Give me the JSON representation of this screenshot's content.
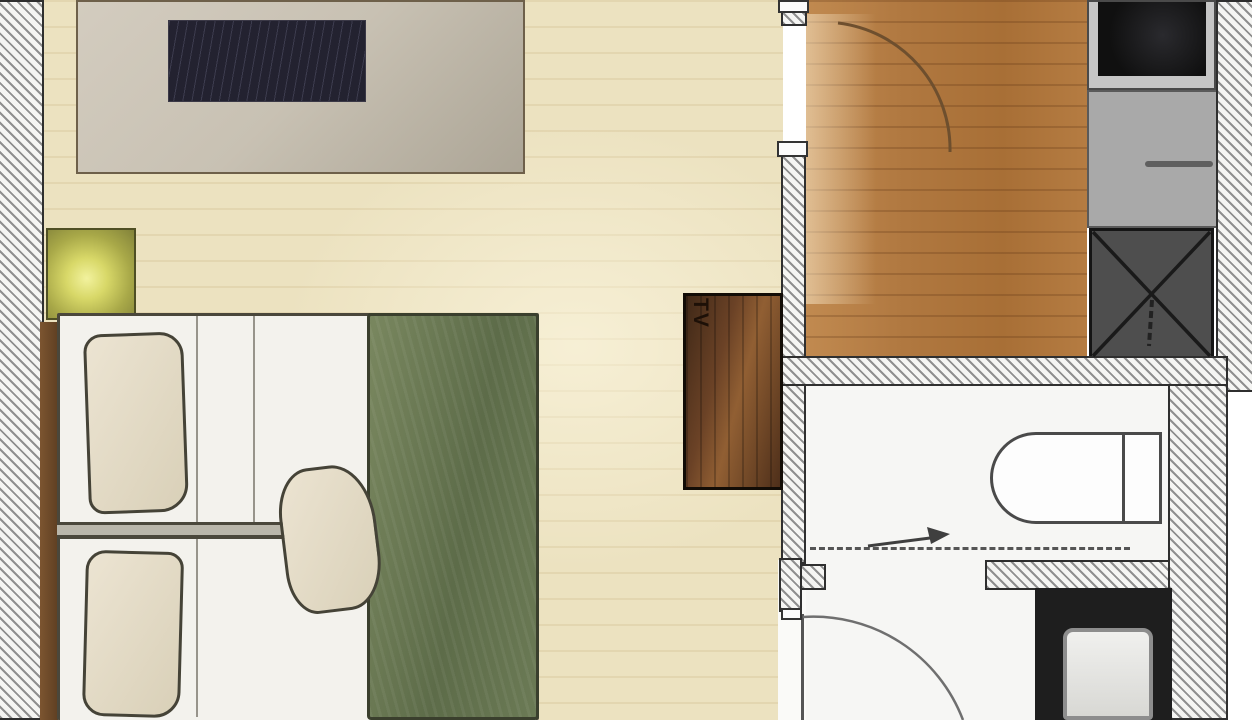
{
  "meta": {
    "title": "Apartment floor plan",
    "kind": "architectural-floorplan-top-view"
  },
  "labels": {
    "tv_cabinet": "TV"
  },
  "colors": {
    "page": "#ffffff",
    "main_floor": "#ece2c0",
    "entry_floor": "#b07840",
    "lower_floor": "#f6f6f4",
    "wall_hatch": "#8f8f8f",
    "wall_bg": "#f5f5f3",
    "wall_outline": "#2f2f2f",
    "sideboard": "#c8c1b3",
    "dark_panel": "#232230",
    "nightstand": "#d8d868",
    "sill": "#5f3f22",
    "bed_white": "#f3f2ed",
    "pillow": "#d9d0b8",
    "sketch": "#4a473b",
    "green_runner": "#6b7a55",
    "tv_cabinet": "#6b4226",
    "tv_label": "#1d1007",
    "cooktop": "#101010",
    "counter": "#a9a9a9",
    "appliance": "#4e4e4e",
    "fixture_outline": "#4a4a4a",
    "vanity": "#1e1e1e",
    "basin": "#f0f0ee"
  },
  "rooms": [
    {
      "name": "bedroom-living-area"
    },
    {
      "name": "entry-hall"
    },
    {
      "name": "kitchenette"
    },
    {
      "name": "bathroom"
    },
    {
      "name": "lower-room"
    }
  ],
  "furniture": [
    {
      "name": "sideboard-with-dark-panel"
    },
    {
      "name": "nightstand-with-lamp"
    },
    {
      "name": "twin-bed-upper"
    },
    {
      "name": "twin-bed-lower"
    },
    {
      "name": "green-bed-runner"
    },
    {
      "name": "pillows"
    },
    {
      "name": "tv-cabinet",
      "label": "TV"
    },
    {
      "name": "cooktop"
    },
    {
      "name": "kitchen-counter"
    },
    {
      "name": "appliance-crossed"
    },
    {
      "name": "toilet"
    },
    {
      "name": "vanity-washbasin"
    },
    {
      "name": "entry-door-swing"
    },
    {
      "name": "bathroom-door-swing"
    },
    {
      "name": "direction-arrow"
    },
    {
      "name": "shower-screen-dashed"
    }
  ]
}
